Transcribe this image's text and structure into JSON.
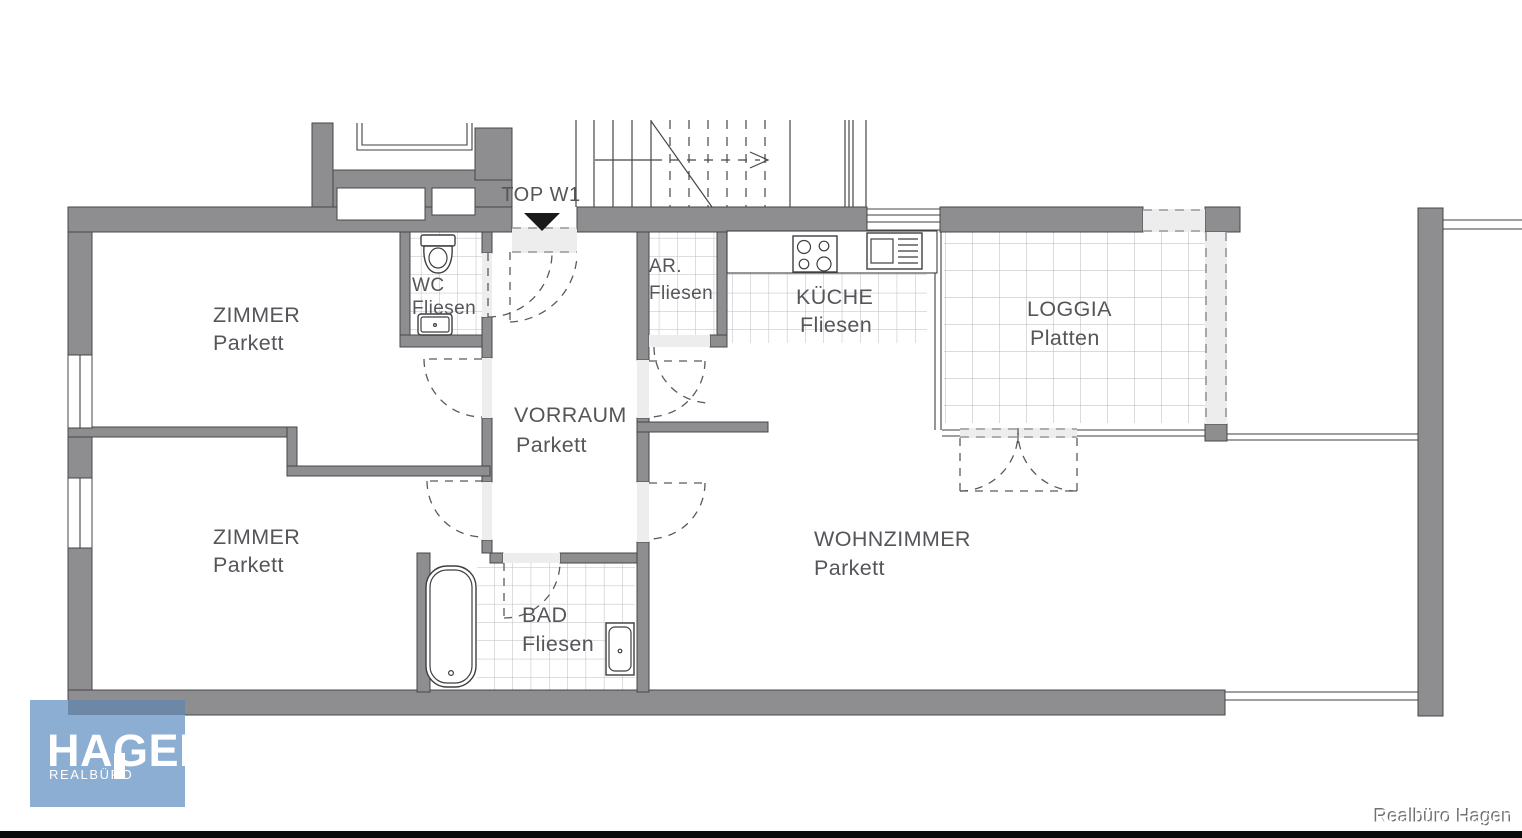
{
  "plan": {
    "unit_label": "TOP W1",
    "rooms": [
      {
        "id": "zimmer-top",
        "name": "ZIMMER",
        "floor": "Parkett"
      },
      {
        "id": "zimmer-bottom",
        "name": "ZIMMER",
        "floor": "Parkett"
      },
      {
        "id": "wc",
        "name": "WC",
        "floor": "Fliesen"
      },
      {
        "id": "vorraum",
        "name": "VORRAUM",
        "floor": "Parkett"
      },
      {
        "id": "abstellraum",
        "name": "AR.",
        "floor": "Fliesen"
      },
      {
        "id": "kueche",
        "name": "KÜCHE",
        "floor": "Fliesen"
      },
      {
        "id": "loggia",
        "name": "LOGGIA",
        "floor": "Platten"
      },
      {
        "id": "wohnzimmer",
        "name": "WOHNZIMMER",
        "floor": "Parkett"
      },
      {
        "id": "bad",
        "name": "BAD",
        "floor": "Fliesen"
      }
    ]
  },
  "branding": {
    "logo_title": "HAGEN",
    "logo_subtitle": "REALBÜRO",
    "watermark": "Realbüro Hagen"
  },
  "colors": {
    "wall": "#8e8e90",
    "tile_line": "#bcbcbc",
    "drawing_line": "#3f3f41",
    "door_band": "#ededed",
    "label_text": "#55555a",
    "entrance_marker": "#1a1a1a",
    "logo_blue": "#8caed3",
    "logo_overlap": "#6d88a6",
    "bottom_bar": "#0a0a0a"
  }
}
